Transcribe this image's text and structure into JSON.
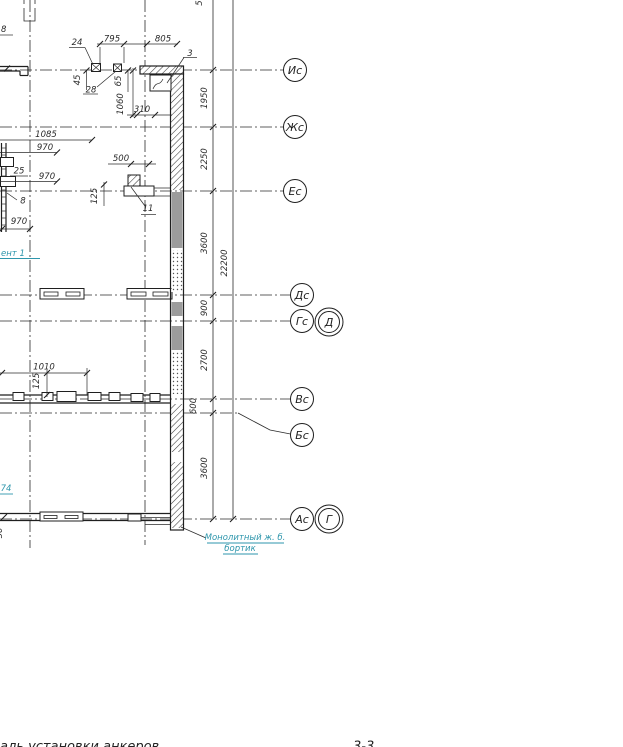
{
  "axes": {
    "is": "Ис",
    "zhs": "Жс",
    "es": "Ес",
    "ds": "Дс",
    "gs": "Гс",
    "d": "Д",
    "vs": "Вс",
    "bs": "Бс",
    "as": "Ас",
    "g": "Г"
  },
  "dims_vertical": {
    "seg1": "1950",
    "seg2": "2250",
    "seg3": "3600",
    "seg4": "900",
    "seg5": "2700",
    "seg6": "600",
    "seg7": "3600",
    "total": "22200",
    "top_partial": "5"
  },
  "dims_top": {
    "d24": "24",
    "d795": "795",
    "d805": "805",
    "d3": "3",
    "d45": "45",
    "d28": "28",
    "d65": "65",
    "d1060": "1060",
    "d310": "310"
  },
  "dims_left": {
    "d8_top": "8",
    "d1085": "1085",
    "d970_1": "970",
    "d25": "25",
    "d970_2": "970",
    "d8": "8",
    "d970_3": "970",
    "d500": "500",
    "d125_1": "125",
    "d11": "11",
    "d1010": "1010",
    "d125_2": "125",
    "d74": "74",
    "d50": "50"
  },
  "notes": {
    "fragment_partial": "ент 1",
    "monolithic_1": "Монолитный ж. б.",
    "monolithic_2": "бортик"
  },
  "footer": {
    "caption_partial": "аль установки анкеров",
    "section_partial": "3-3"
  },
  "colors": {
    "ink": "#2b2b2b",
    "teal": "#2e96ac",
    "grey_fill": "#9c9c9c"
  }
}
